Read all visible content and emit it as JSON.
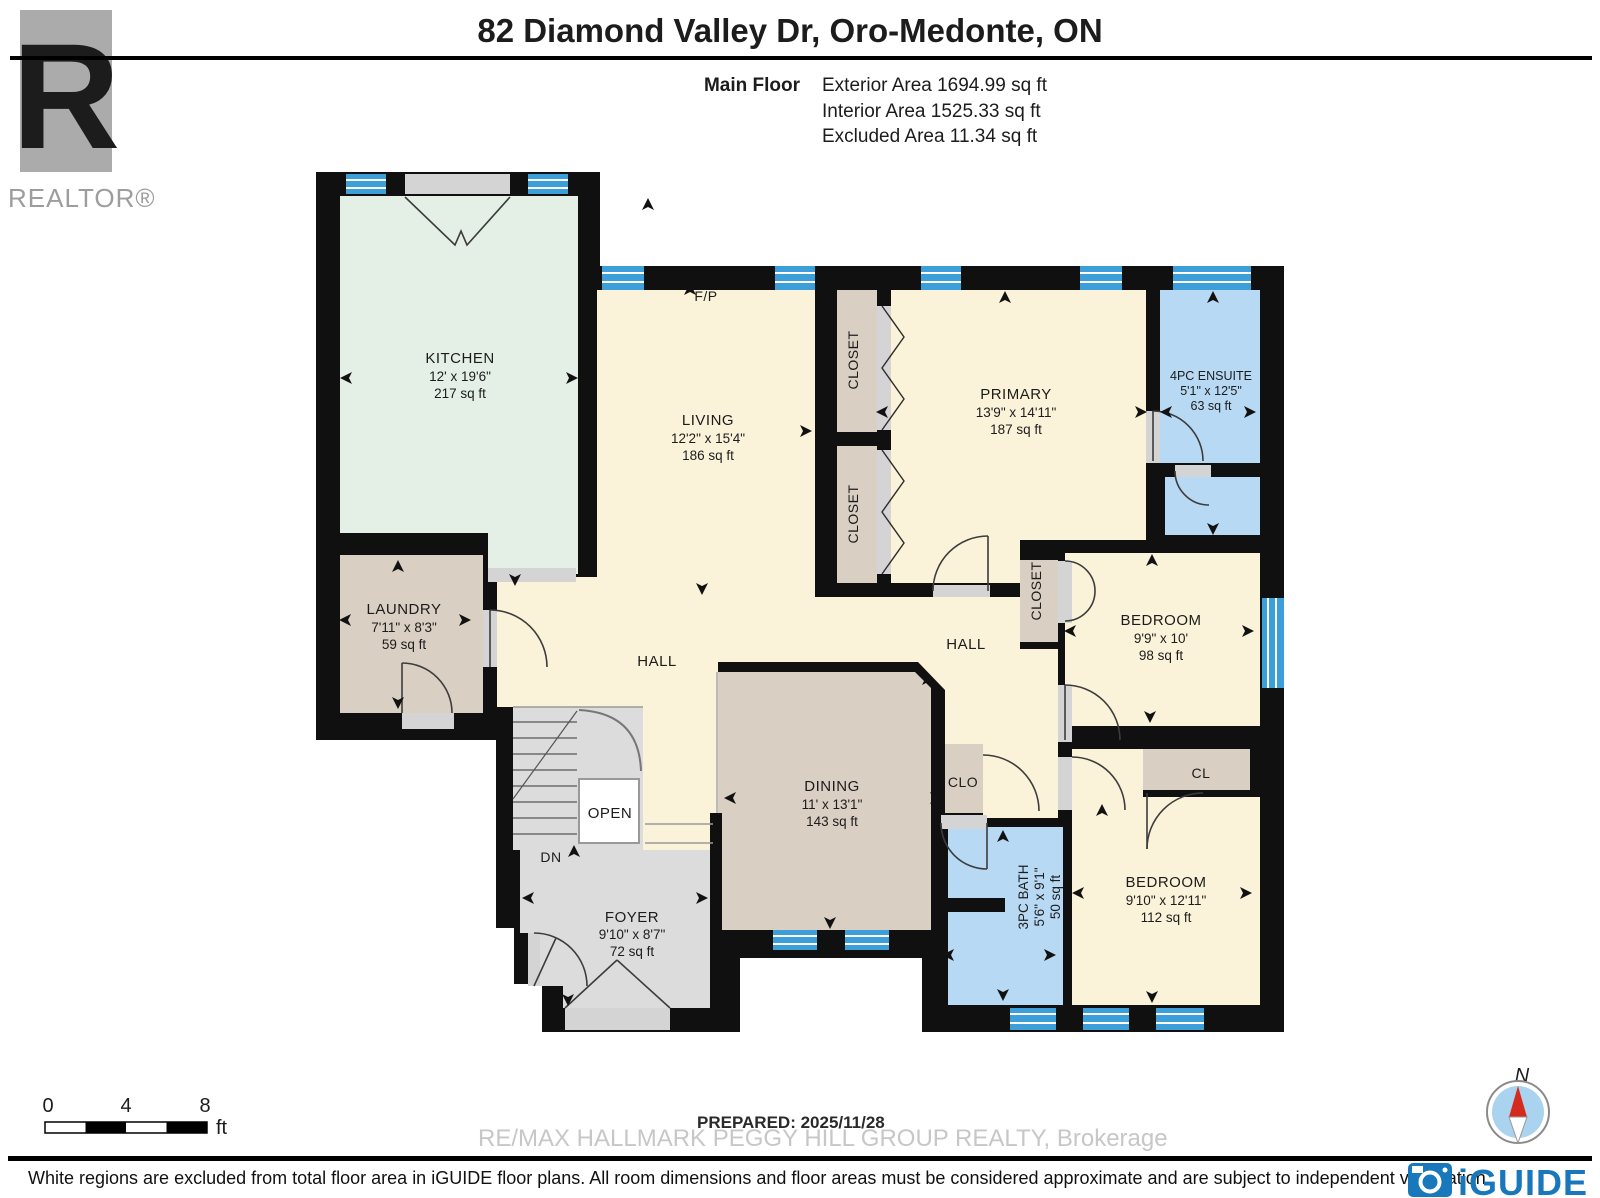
{
  "header": {
    "title": "82 Diamond Valley Dr, Oro-Medonte, ON",
    "floor_label": "Main Floor",
    "stats": [
      "Exterior Area 1694.99 sq ft",
      "Interior Area 1525.33 sq ft",
      "Excluded Area 11.34 sq ft"
    ]
  },
  "realtor": {
    "label": "REALTOR®",
    "monogram": "R"
  },
  "rooms": [
    {
      "id": "kitchen",
      "name": "KITCHEN",
      "dims": "12' x 19'6\"",
      "area": "217 sq ft"
    },
    {
      "id": "living",
      "name": "LIVING",
      "dims": "12'2\" x 15'4\"",
      "area": "186 sq ft"
    },
    {
      "id": "primary",
      "name": "PRIMARY",
      "dims": "13'9\" x 14'11\"",
      "area": "187 sq ft"
    },
    {
      "id": "ensuite",
      "name": "4PC ENSUITE",
      "dims": "5'1\" x 12'5\"",
      "area": "63 sq ft"
    },
    {
      "id": "laundry",
      "name": "LAUNDRY",
      "dims": "7'11\" x 8'3\"",
      "area": "59 sq ft"
    },
    {
      "id": "bedroom-1",
      "name": "BEDROOM",
      "dims": "9'9\" x 10'",
      "area": "98 sq ft"
    },
    {
      "id": "bedroom-2",
      "name": "BEDROOM",
      "dims": "9'10\" x 12'11\"",
      "area": "112 sq ft"
    },
    {
      "id": "bath",
      "name": "3PC BATH",
      "dims": "5'6\" x 9'1\"",
      "area": "50 sq ft"
    },
    {
      "id": "dining",
      "name": "DINING",
      "dims": "11' x 13'1\"",
      "area": "143 sq ft"
    },
    {
      "id": "foyer",
      "name": "FOYER",
      "dims": "9'10\" x 8'7\"",
      "area": "72 sq ft"
    }
  ],
  "labels": {
    "hall_left": "HALL",
    "hall_right": "HALL",
    "closet_primary_1": "CLOSET",
    "closet_primary_2": "CLOSET",
    "closet_bedroom": "CLOSET",
    "cl": "CL",
    "clo": "CLO",
    "open": "OPEN",
    "dn": "DN",
    "fireplace": "F/P"
  },
  "scale_bar": {
    "ticks": [
      "0",
      "4",
      "8"
    ],
    "unit": "ft"
  },
  "compass": {
    "north_label": "N"
  },
  "footer": {
    "prepared": "PREPARED: 2025/11/28",
    "watermark": "RE/MAX HALLMARK PEGGY HILL GROUP REALTY, Brokerage",
    "disclaimer": "White regions are excluded from total floor area in iGUIDE floor plans. All room dimensions and floor areas must be considered approximate and are subject to independent verification.",
    "brand": "iGUIDE"
  },
  "colors": {
    "wall": "#101010",
    "room_cream": "#faf3d9",
    "room_green": "#e4efe6",
    "room_taupe": "#d9cfc3",
    "room_gray": "#dcdcdc",
    "room_blue": "#b7d9f3",
    "window_blue": "#3d9fd9",
    "threshold": "#d4d4d4",
    "accent_brand": "#1878bb",
    "compass_red": "#d42b1e",
    "compass_blue": "#a9d3ee"
  }
}
